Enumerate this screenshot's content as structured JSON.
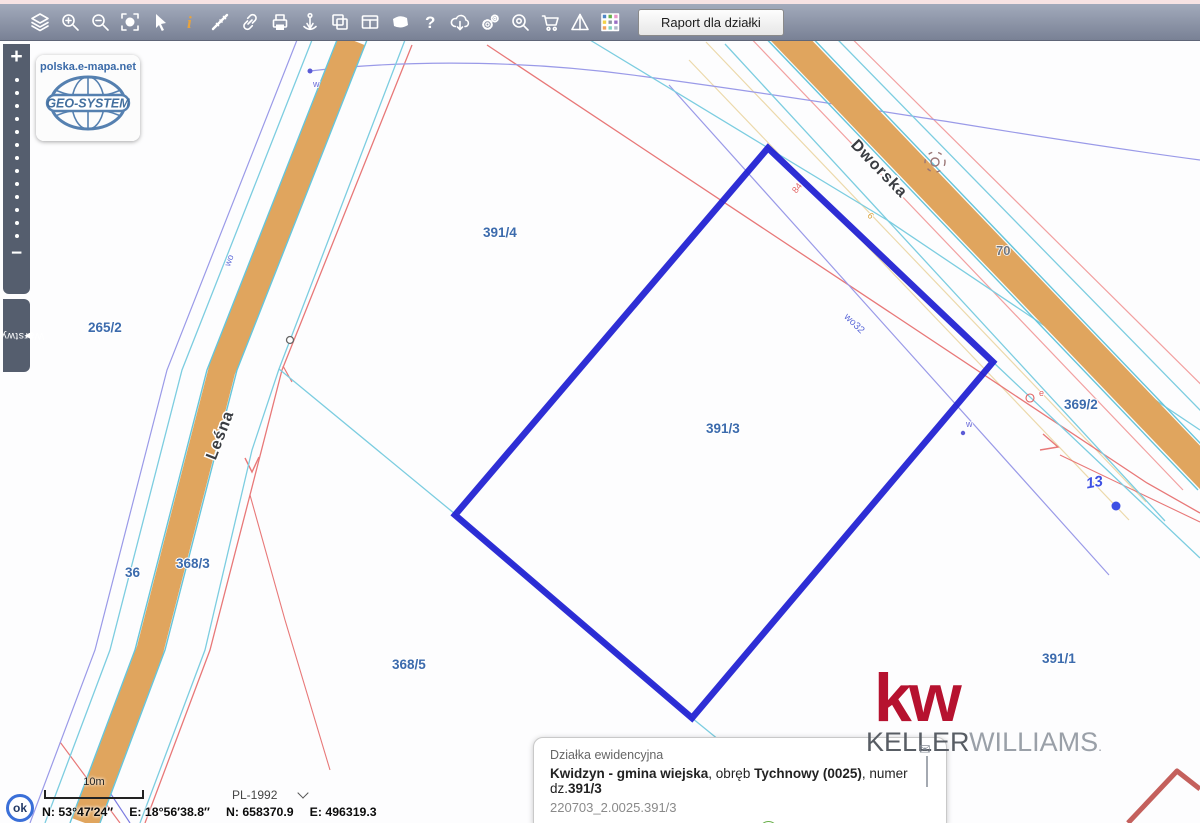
{
  "toolbar": {
    "report_button": "Raport dla działki"
  },
  "logo_card": {
    "site": "polska.e-mapa.net",
    "brand": "GEO-SYSTEM"
  },
  "sidebar": {
    "zoom_in": "+",
    "zoom_out": "−",
    "layers_tab": "Warstwy"
  },
  "map": {
    "streets": {
      "lesna": "Leśna",
      "dworska": "Dworska"
    },
    "parcels": {
      "p265_2": "265/2",
      "p391_4": "391/4",
      "p391_3": "391/3",
      "p369_2": "369/2",
      "p368_3": "368/3",
      "p36": "36",
      "p368_5": "368/5",
      "p391_1": "391/1"
    },
    "annotations": {
      "n70": "70",
      "n13": "13",
      "wo32": "wo32",
      "wo": "wo",
      "w_top": "w",
      "w_right": "w",
      "e_mark": "e",
      "n84": "84",
      "n6": "6"
    }
  },
  "watermark": {
    "kw": "kw",
    "keller": "KELLER",
    "williams": "WILLIAMS",
    "dot": "."
  },
  "info_panel": {
    "title": "Działka ewidencyjna",
    "name_bold": "Kwidzyn - gmina wiejska",
    "sep1": ", obręb ",
    "area_bold": "Tychnowy (0025)",
    "sep2": ", numer dz.",
    "number_bold": "391/3",
    "ident": "220703_2.0025.391/3",
    "link_zoom": "Zbliż do obiektu",
    "link_details": "Szczegóły (I)",
    "link_other": "Inne"
  },
  "statusbar": {
    "ok": "ok",
    "scale_label": "10m",
    "crs": "PL-1992",
    "coord_geo_n": "N: 53°47′24″",
    "coord_geo_e": "E: 18°56′38.8″",
    "coord_grid_n": "N: 658370.9",
    "coord_grid_e": "E: 496319.3"
  },
  "colors": {
    "road": "#e0a55e",
    "cyan_line": "#66c5da",
    "red_line": "#e87878",
    "pink_line": "#f2a0a0",
    "violet_line": "#9a9ae8",
    "wheat_line": "#ecd9ab",
    "selection_blue": "#1e1ed2",
    "parcel_label": "#3c6bad",
    "kw_red": "#b6122f",
    "link_blue": "#1a73e8"
  }
}
